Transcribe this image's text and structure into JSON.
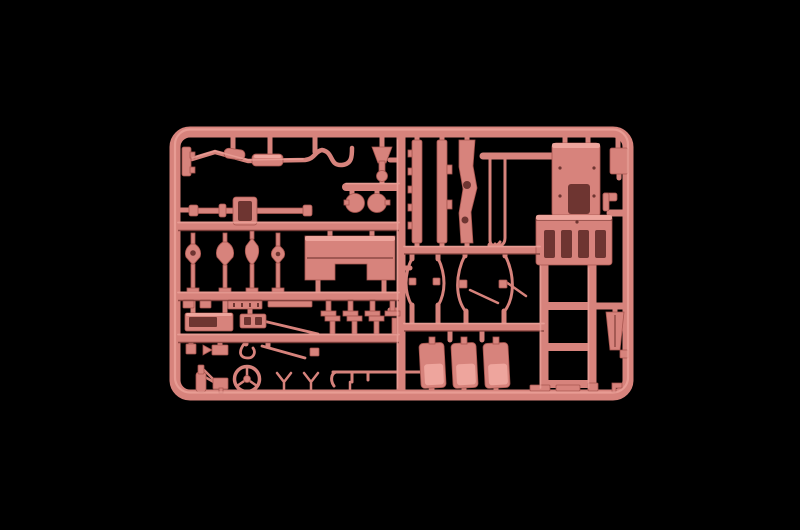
{
  "scene": {
    "caption": "Salmon-pink injection-molded model kit sprue (parts tree) photographed on a black background",
    "subject": "Plastic model kit sprue with truck parts",
    "background_color_name": "black",
    "plastic_color_name": "salmon pink"
  },
  "colors": {
    "background": "#000000",
    "sprue_base": "#d7837c",
    "sprue_light": "#f1aaa1",
    "sprue_dark": "#a8564f",
    "sprue_deep": "#7c3b37",
    "slot": "#6e3531"
  },
  "counts": {
    "seats": 3,
    "lamps_horns": 4,
    "chassis_rails": 3,
    "leaf_springs": 4,
    "mufflers": 2
  },
  "parts": [
    {
      "name": "Sprue frame and runners"
    },
    {
      "name": "Exhaust pipe with twin mufflers"
    },
    {
      "name": "Intake funnel / air horn"
    },
    {
      "name": "Twin air tanks"
    },
    {
      "name": "Front axle with differential housing"
    },
    {
      "name": "Notched chassis rail"
    },
    {
      "name": "Straight chassis rail"
    },
    {
      "name": "Contoured chassis rail with lightening holes"
    },
    {
      "name": "Thin linkage rods"
    },
    {
      "name": "Cab floor and firewall panel"
    },
    {
      "name": "Ribbed lower panel"
    },
    {
      "name": "Side bracket"
    },
    {
      "name": "Dashboard cowl"
    },
    {
      "name": "Horn and lamp parts"
    },
    {
      "name": "Small plates and strips"
    },
    {
      "name": "Toolbox"
    },
    {
      "name": "Bumper strip"
    },
    {
      "name": "Diagonal linkage rod"
    },
    {
      "name": "Assorted small clips"
    },
    {
      "name": "Oil bottle"
    },
    {
      "name": "Pedal bracket"
    },
    {
      "name": "Steering wheel"
    },
    {
      "name": "Mirror arms"
    },
    {
      "name": "Stabilizer bar"
    },
    {
      "name": "Small leaf spring pair"
    },
    {
      "name": "Large leaf spring pair"
    },
    {
      "name": "Pedal bracket rows"
    },
    {
      "name": "Seats"
    },
    {
      "name": "Ladder sub-frame"
    },
    {
      "name": "Mud flap blade"
    },
    {
      "name": "Flat mounting strips"
    }
  ]
}
